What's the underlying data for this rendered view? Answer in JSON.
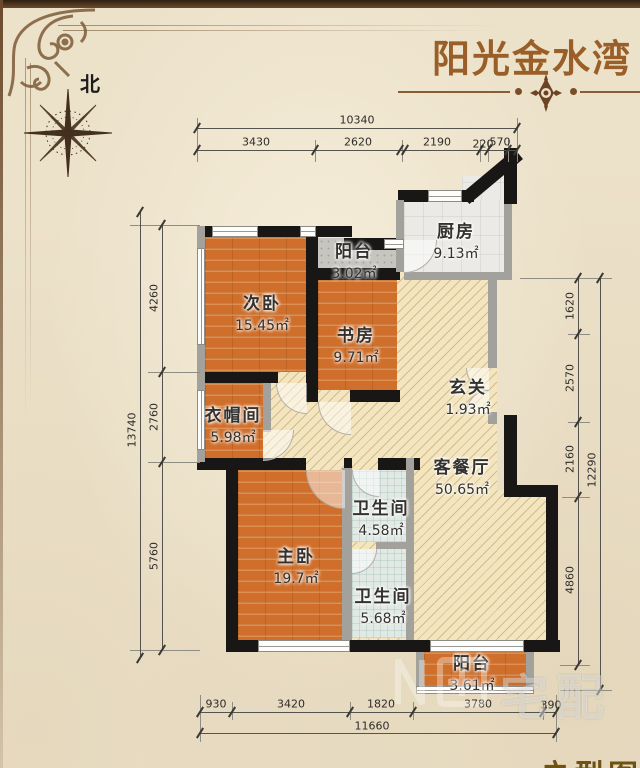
{
  "page": {
    "title": "阳光金水湾",
    "north_label": "北",
    "caption_partial": "户型图",
    "watermark": "宅配",
    "accent_color": "#9a5f28",
    "wall_color": "#181715",
    "paper_color": "#ece1c9"
  },
  "rooms": {
    "secondary_bedroom": {
      "name": "次卧",
      "area": "15.45㎡"
    },
    "balcony_top": {
      "name": "阳台",
      "area": "3.02㎡"
    },
    "kitchen": {
      "name": "厨房",
      "area": "9.13㎡"
    },
    "study": {
      "name": "书房",
      "area": "9.71㎡"
    },
    "foyer": {
      "name": "玄关",
      "area": "1.93㎡"
    },
    "cloakroom": {
      "name": "衣帽间",
      "area": "5.98㎡"
    },
    "living_dining": {
      "name": "客餐厅",
      "area": "50.65㎡"
    },
    "bathroom_1": {
      "name": "卫生间",
      "area": "4.58㎡"
    },
    "master_bedroom": {
      "name": "主卧",
      "area": "19.7㎡"
    },
    "bathroom_2": {
      "name": "卫生间",
      "area": "5.68㎡"
    },
    "balcony_bottom": {
      "name": "阳台",
      "area": "3.61㎡"
    }
  },
  "dimensions": {
    "top": {
      "total": "10340",
      "segments": [
        "3430",
        "2620",
        "2190",
        "220",
        "570"
      ]
    },
    "left": {
      "total": "13740",
      "segments": [
        "4260",
        "2760",
        "5760"
      ]
    },
    "right": {
      "total": "12290",
      "segments": [
        "1620",
        "2570",
        "2160",
        "4860"
      ]
    },
    "bottom": {
      "total": "11660",
      "segments": [
        "930",
        "3420",
        "1820",
        "3780",
        "390"
      ]
    }
  }
}
